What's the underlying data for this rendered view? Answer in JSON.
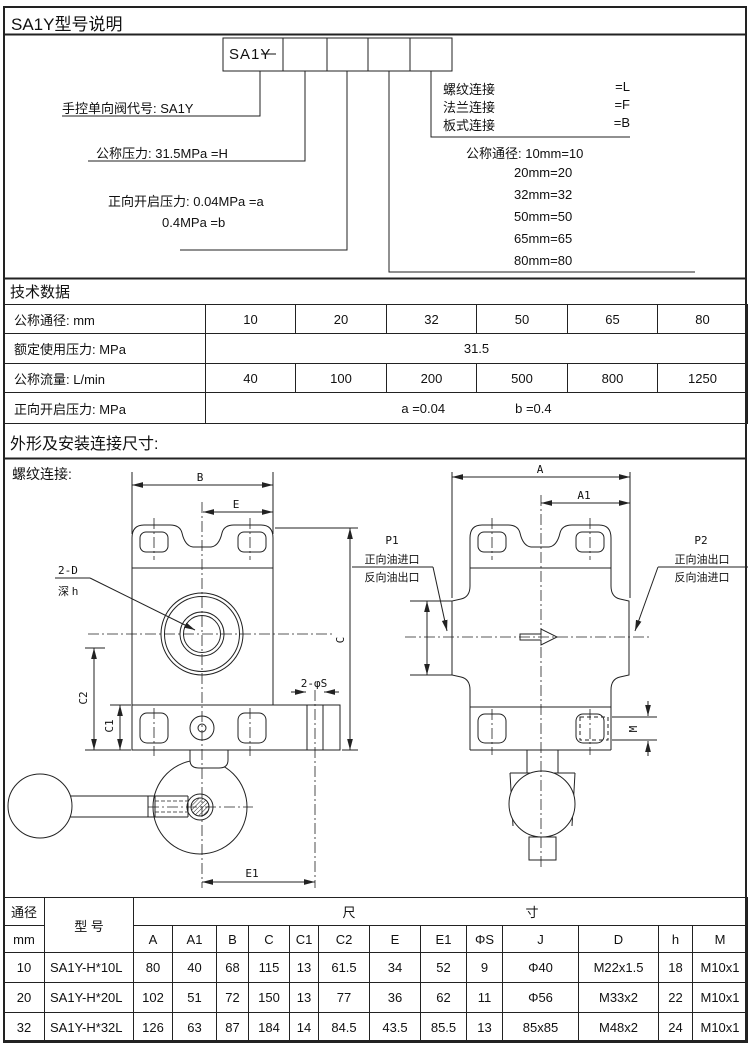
{
  "page": {
    "title": "SA1Y型号说明",
    "tech_title": "技术数据",
    "outline_title": "外形及安装连接尺寸:",
    "outline_sub": "螺纹连接:"
  },
  "model_code": {
    "box_text": "SA1Y",
    "dash": "—",
    "valve_code_label": "手控单向阀代号: SA1Y",
    "pressure_label": "公称压力: 31.5MPa  =H",
    "open_pressure_label_1": "正向开启压力: 0.04MPa =a",
    "open_pressure_label_2": "0.4MPa  =b",
    "connections": [
      {
        "label": "螺纹连接",
        "code": "=L"
      },
      {
        "label": "法兰连接",
        "code": "=F"
      },
      {
        "label": "板式连接",
        "code": "=B"
      }
    ],
    "diameter_first": "公称通径: 10mm=10",
    "diameters": [
      "20mm=20",
      "32mm=32",
      "50mm=50",
      "65mm=65",
      "80mm=80"
    ]
  },
  "tech_table": {
    "rows": [
      {
        "label": "公称通径: mm",
        "values": [
          "10",
          "20",
          "32",
          "50",
          "65",
          "80"
        ]
      },
      {
        "label": "额定使用压力: MPa",
        "value": "31.5"
      },
      {
        "label": "公称流量: L/min",
        "values": [
          "40",
          "100",
          "200",
          "500",
          "800",
          "1250"
        ]
      },
      {
        "label": "正向开启压力: MPa",
        "value_a": "a =0.04",
        "value_b": "b =0.4"
      }
    ]
  },
  "drawing": {
    "dim_b": "B",
    "dim_e": "E",
    "dim_c": "C",
    "dim_c1": "C1",
    "dim_c2": "C2",
    "dim_e1": "E1",
    "holes_label": "2-φS",
    "bore_label": "2-D",
    "bore_depth": "深 h",
    "dim_a": "A",
    "dim_a1": "A1",
    "dim_m": "M",
    "p1": {
      "name": "P1",
      "line1": "正向油进口",
      "line2": "反向油出口"
    },
    "p2": {
      "name": "P2",
      "line1": "正向油出口",
      "line2": "反向油进口"
    }
  },
  "dim_table": {
    "dn_header": "通径",
    "dn_unit": "mm",
    "model_header": "型 号",
    "size_left": "尺",
    "size_right": "寸",
    "columns": [
      "A",
      "A1",
      "B",
      "C",
      "C1",
      "C2",
      "E",
      "E1",
      "ΦS",
      "J",
      "D",
      "h",
      "M"
    ],
    "rows": [
      {
        "dn": "10",
        "model": "SA1Y-H*10L",
        "values": [
          "80",
          "40",
          "68",
          "115",
          "13",
          "61.5",
          "34",
          "52",
          "9",
          "Φ40",
          "M22x1.5",
          "18",
          "M10x1"
        ]
      },
      {
        "dn": "20",
        "model": "SA1Y-H*20L",
        "values": [
          "102",
          "51",
          "72",
          "150",
          "13",
          "77",
          "36",
          "62",
          "11",
          "Φ56",
          "M33x2",
          "22",
          "M10x1"
        ]
      },
      {
        "dn": "32",
        "model": "SA1Y-H*32L",
        "values": [
          "126",
          "63",
          "87",
          "184",
          "14",
          "84.5",
          "43.5",
          "85.5",
          "13",
          "85x85",
          "M48x2",
          "24",
          "M10x1"
        ]
      }
    ]
  }
}
